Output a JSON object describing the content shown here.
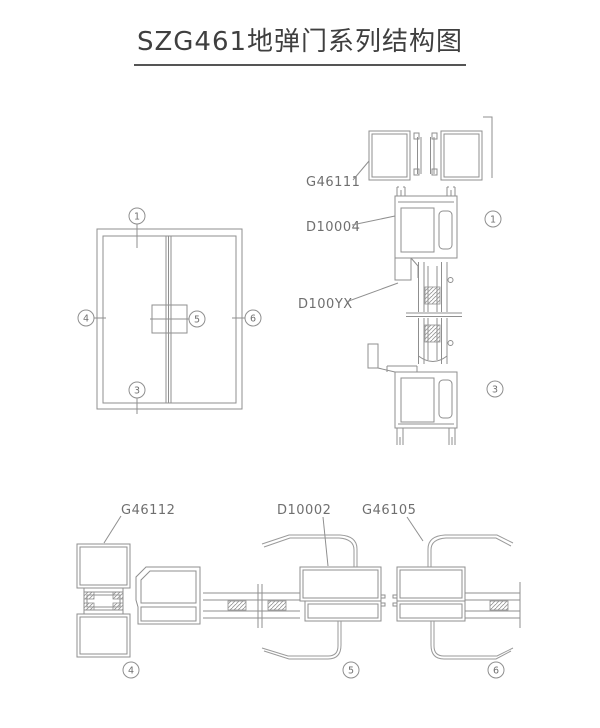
{
  "title": "SZG461地弹门系列结构图",
  "colors": {
    "line": "#8f8f8f",
    "label": "#6f6f6f",
    "title": "#3f3f3f"
  },
  "elevation": {
    "balloons": {
      "top": "1",
      "left": "4",
      "center": "5",
      "right": "6",
      "bottom": "3"
    }
  },
  "vertical_section": {
    "labels": {
      "head": "G46111",
      "rail": "D10004",
      "bead": "D100YX"
    },
    "balloons": {
      "top": "1",
      "bottom": "3"
    }
  },
  "horizontal_section": {
    "labels": {
      "jamb": "G46112",
      "stile": "D10002",
      "meeting": "G46105"
    },
    "balloons": {
      "left": "4",
      "center": "5",
      "right": "6"
    }
  }
}
